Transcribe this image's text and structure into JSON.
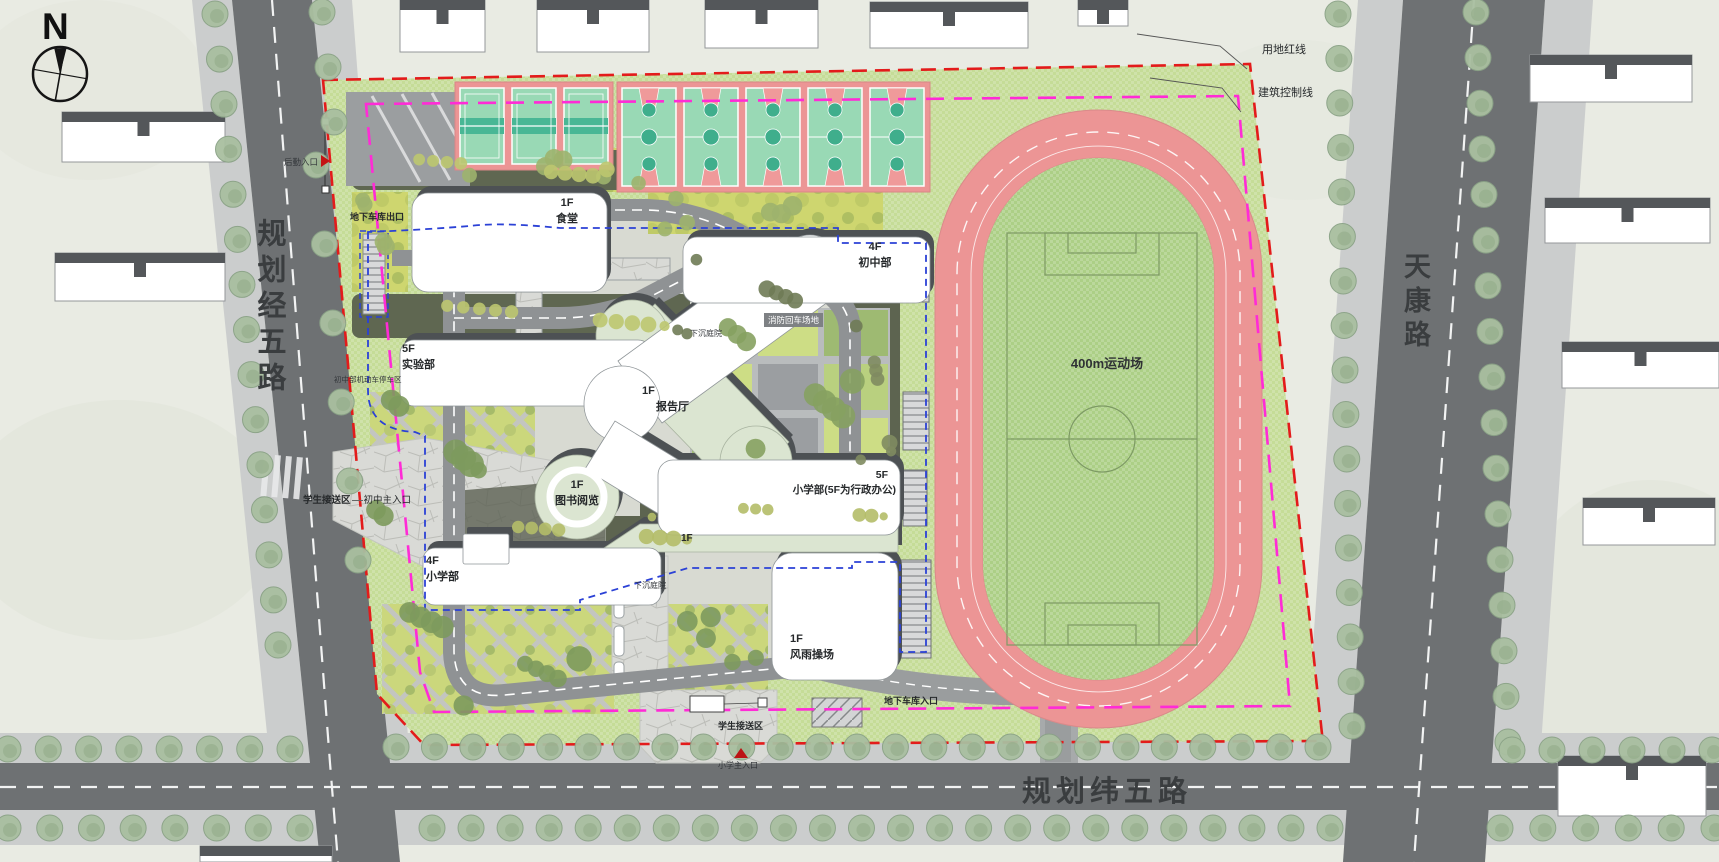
{
  "compass": {
    "north_label": "N"
  },
  "roads": {
    "west": "规划经五路",
    "east": "天康路",
    "south": "规划纬五路"
  },
  "legend": {
    "site_boundary": "用地红线",
    "building_control": "建筑控制线"
  },
  "buildings": {
    "canteen": {
      "floor": "1F",
      "name": "食堂"
    },
    "junior_high": {
      "floor": "4F",
      "name": "初中部"
    },
    "laboratory": {
      "floor": "5F",
      "name": "实验部"
    },
    "lecture_hall": {
      "floor": "1F",
      "name": "报告厅"
    },
    "library": {
      "floor": "1F",
      "name": "图书阅览"
    },
    "primary_admin": {
      "floor": "5F",
      "name": "小学部(5F为行政办公)"
    },
    "primary": {
      "floor": "4F",
      "name": "小学部"
    },
    "indoor_gym": {
      "floor": "1F",
      "name": "风雨操场"
    },
    "podium_link": {
      "floor": "1F"
    }
  },
  "track": {
    "label": "400m运动场"
  },
  "annotations": {
    "fire_truck_turnaround": "消防回车场地",
    "sunken_courtyard": "下沉庭院",
    "garage_exit": "地下车库出口",
    "garage_entrance": "地下车库入口",
    "logistics_entrance": "后勤入口",
    "student_pick_up_west": "学生接送区",
    "junior_main_entrance": "初中主入口",
    "student_pick_up_south": "学生接送区",
    "primary_main_entrance": "小学主入口",
    "junior_parking": "初中部机动车停车区"
  },
  "colors": {
    "site_boundary": "#e31b1b",
    "building_control": "#ff2bd6",
    "garage_outline": "#2b41d6",
    "track_pink": "#ec9595",
    "court_green": "#99d9b5",
    "lawn_green": "#c5dc97"
  }
}
